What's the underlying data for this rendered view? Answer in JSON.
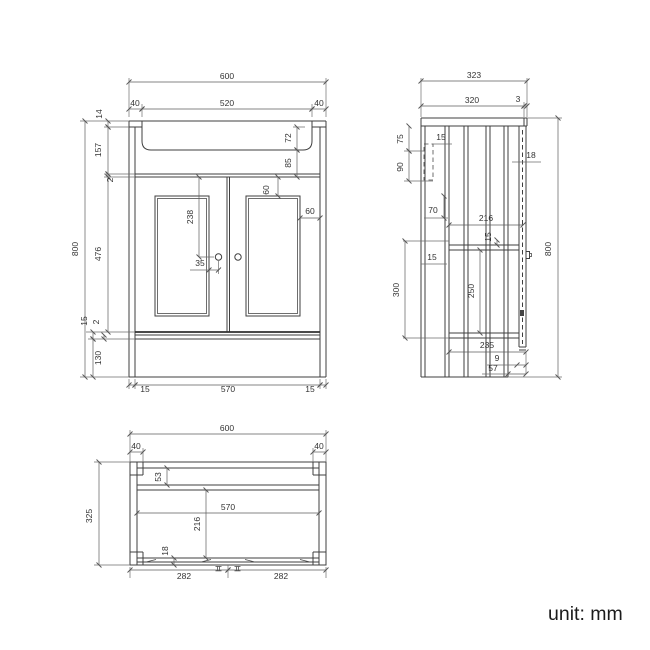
{
  "unit_note": "unit: mm",
  "front_view": {
    "overall_width": "600",
    "basin_rim_left": "40",
    "basin_rim_width": "520",
    "basin_rim_right": "40",
    "worktop_thickness": "14",
    "upper_section_height": "157",
    "top_gap": "2",
    "door_height": "476",
    "bottom_rail": "15",
    "bottom_gap": "2",
    "plinth_height": "130",
    "overall_height": "800",
    "basin_depth": "72",
    "apron_height": "85",
    "door_top_margin": "60",
    "door_side_margin": "60",
    "handle_drop": "238",
    "handle_inset": "35",
    "base_inset_left": "15",
    "base_width": "570",
    "base_inset_right": "15"
  },
  "side_view": {
    "overall_depth": "323",
    "worktop_depth": "320",
    "front_lip": "3",
    "bracket_offset": "75",
    "bracket_gap": "15",
    "bracket_height": "90",
    "rail_drop": "70",
    "door_thickness": "18",
    "shelf_depth": "216",
    "shelf_thickness": "15",
    "shelf_edge_gap": "15",
    "shelf_zone_height": "300",
    "shelf_clearance": "250",
    "base_depth": "235",
    "toe_gap": "9",
    "toe_recess": "57",
    "overall_height": "800"
  },
  "plan_view": {
    "overall_width": "600",
    "corner_post_left": "40",
    "corner_post_right": "40",
    "overall_depth": "325",
    "back_rail_depth": "53",
    "interior_width": "570",
    "interior_depth": "216",
    "front_rail_depth": "18",
    "handle_span_left": "282",
    "handle_span_right": "282"
  }
}
